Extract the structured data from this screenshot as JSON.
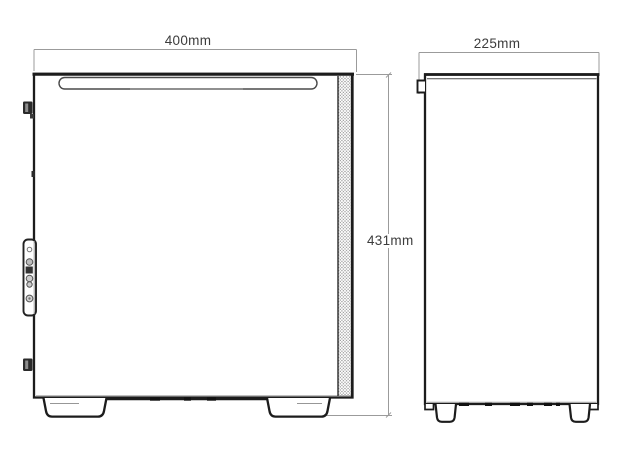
{
  "page": {
    "type": "product-dimension-diagram",
    "subject": "computer-case-two-view-outline-drawing",
    "background": "#ffffff"
  },
  "views": {
    "side_view": {
      "width_label": "400mm",
      "height_label": "431mm"
    },
    "front_view": {
      "width_label": "225mm"
    }
  },
  "colors": {
    "outline": "#1c1c1c",
    "secondary_line": "#555555",
    "faint_line": "#a8a8a8",
    "dimension_line": "#9b9b9b",
    "label_text": "#3c3c3c",
    "mesh_dot": "#8f8f8f",
    "fill": "#ffffff"
  }
}
